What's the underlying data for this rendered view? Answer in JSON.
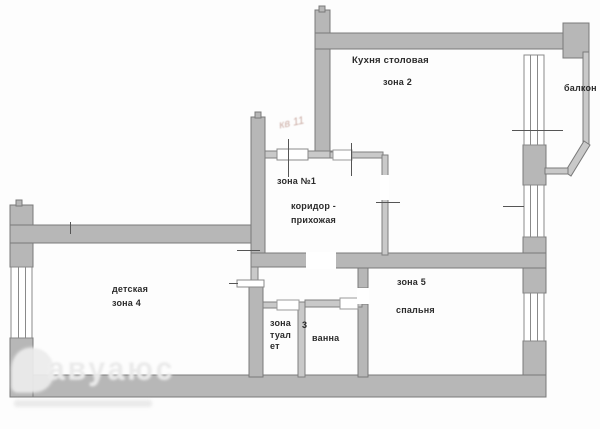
{
  "plan": {
    "type": "apartment-floor-plan",
    "language": "ru",
    "labels": {
      "kitchen_title": "Кухня столовая",
      "kitchen_zone": "зона 2",
      "balcony": "балкон",
      "zone1": "зона №1",
      "corridor": "коридор -\nприхожая",
      "nursery": "детская",
      "nursery_zone": "зона 4",
      "zone5": "зона 5",
      "bedroom": "спальня",
      "toilet": "зона\nтуал\nет",
      "bath_zone_number": "3",
      "bath": "ванна",
      "handwritten_note": "кв 11",
      "watermark": "авуаюс"
    },
    "colors": {
      "wall_thick": "#b7b7b7",
      "wall_thin": "#c9c9c9",
      "wall_edge": "#7a7a7a",
      "window_line": "#8a8a8a",
      "tick_line": "#555555",
      "text": "#2b2b2b",
      "handwriting": "#c09a90",
      "paper": "#fdfdfd"
    }
  }
}
